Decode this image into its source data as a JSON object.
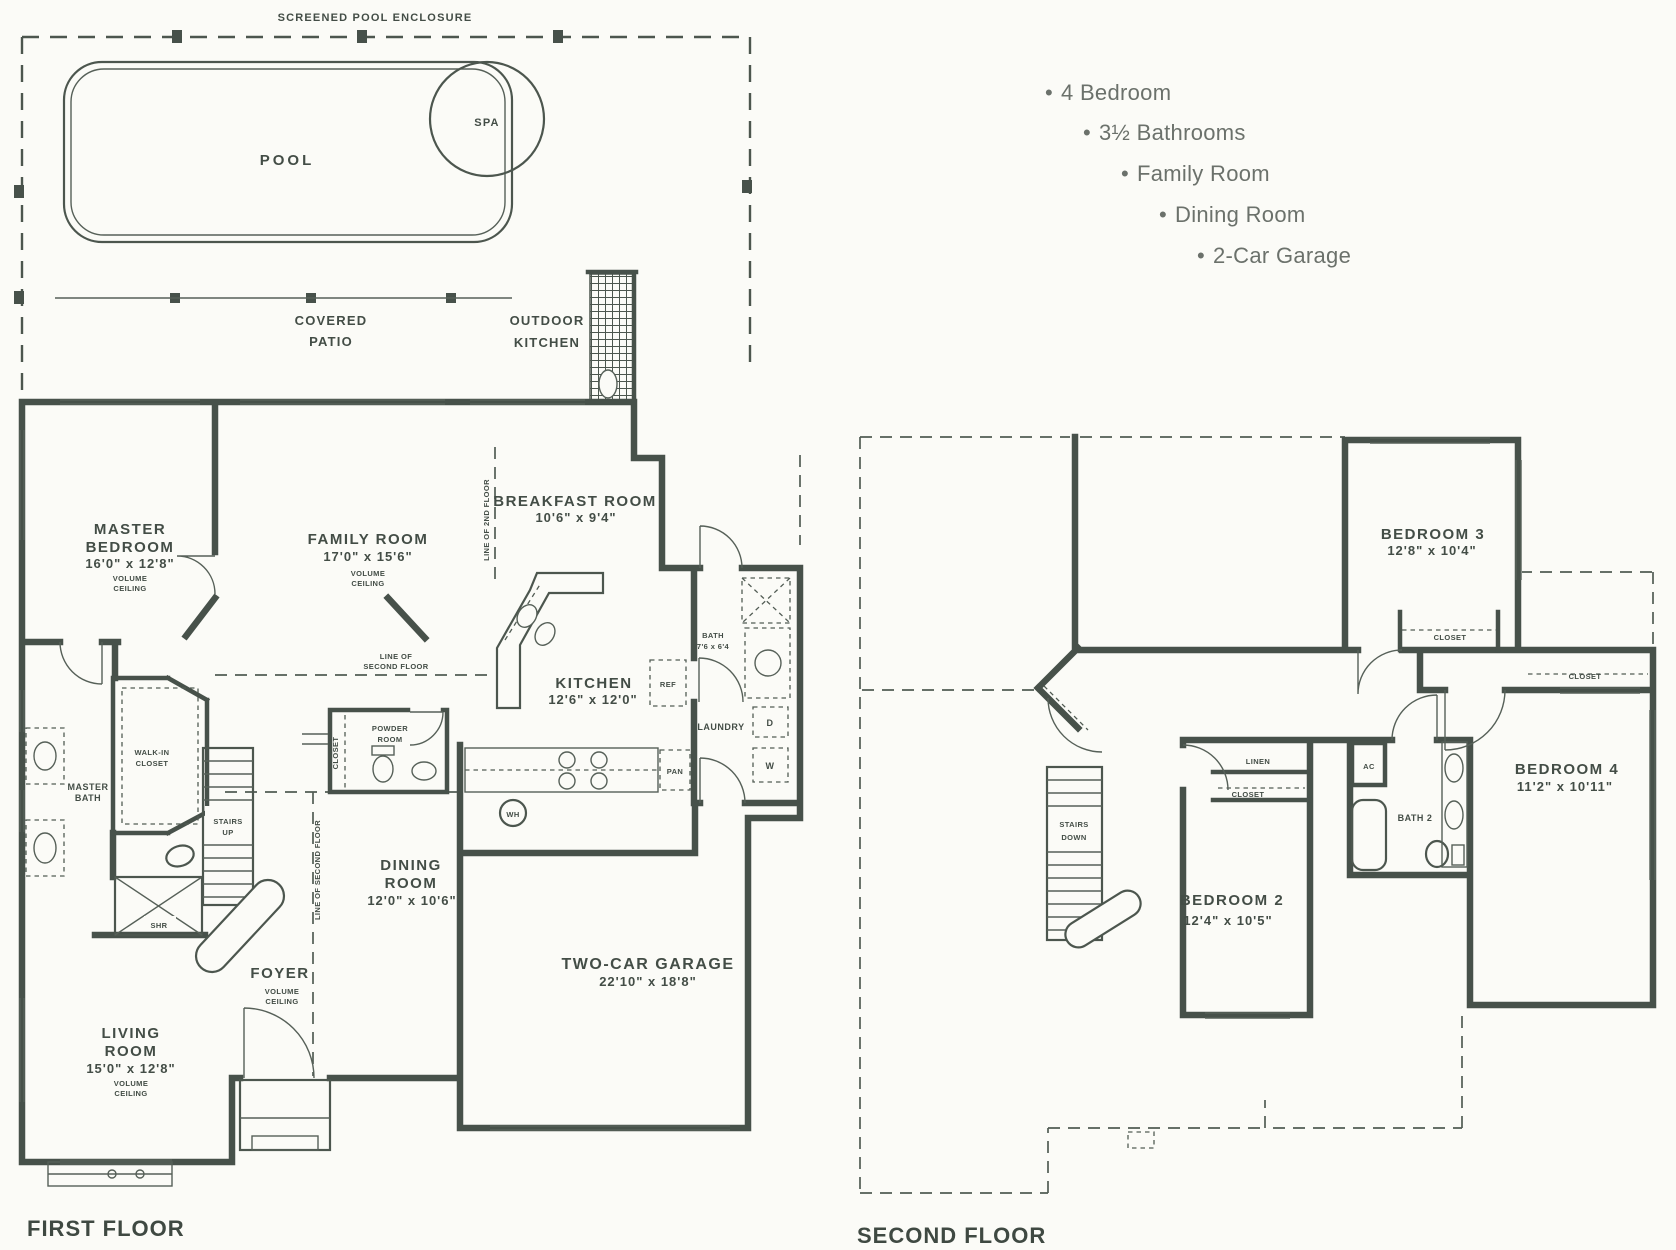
{
  "features": {
    "bullet": "•",
    "items": [
      "4 Bedroom",
      "3½ Bathrooms",
      "Family Room",
      "Dining Room",
      "2-Car Garage"
    ]
  },
  "outdoor": {
    "enclosure": "SCREENED POOL ENCLOSURE",
    "pool": "POOL",
    "spa": "SPA",
    "covered_patio": [
      "COVERED",
      "PATIO"
    ],
    "outdoor_kitchen": [
      "OUTDOOR",
      "KITCHEN"
    ]
  },
  "first_floor": {
    "title": "FIRST FLOOR",
    "rooms": {
      "master_bedroom": [
        "MASTER",
        "BEDROOM",
        "16'0\" x 12'8\"",
        "VOLUME",
        "CEILING"
      ],
      "family_room": [
        "FAMILY ROOM",
        "17'0\" x 15'6\"",
        "VOLUME",
        "CEILING"
      ],
      "breakfast_room": [
        "BREAKFAST ROOM",
        "10'6\" x 9'4\""
      ],
      "kitchen": [
        "KITCHEN",
        "12'6\" x 12'0\""
      ],
      "dining_room": [
        "DINING",
        "ROOM",
        "12'0\" x 10'6\""
      ],
      "living_room": [
        "LIVING",
        "ROOM",
        "15'0\" x 12'8\"",
        "VOLUME",
        "CEILING"
      ],
      "garage": [
        "TWO-CAR GARAGE",
        "22'10\" x 18'8\""
      ],
      "foyer": [
        "FOYER",
        "VOLUME",
        "CEILING"
      ],
      "master_bath": [
        "MASTER",
        "BATH"
      ],
      "walk_in_closet": [
        "WALK-IN",
        "CLOSET"
      ],
      "powder_room": [
        "POWDER",
        "ROOM"
      ],
      "bath": [
        "BATH",
        "7'6 x 6'4"
      ],
      "stairs": [
        "STAIRS",
        "UP"
      ]
    },
    "small_labels": {
      "shr": "SHR",
      "closet": "CLOSET",
      "ref": "REF",
      "pan": "PAN",
      "wh": "WH",
      "laundry": "LAUNDRY",
      "dryer": "D",
      "washer": "W",
      "line_of": "LINE OF",
      "second_floor": "SECOND FLOOR",
      "line_of_2nd_floor": "LINE OF 2ND FLOOR",
      "line_of_second_floor": "LINE OF SECOND FLOOR"
    }
  },
  "second_floor": {
    "title": "SECOND FLOOR",
    "rooms": {
      "bedroom_2": [
        "BEDROOM 2",
        "12'4\" x 10'5\""
      ],
      "bedroom_3": [
        "BEDROOM 3",
        "12'8\" x 10'4\""
      ],
      "bedroom_4": [
        "BEDROOM 4",
        "11'2\" x 10'11\""
      ],
      "bath_2": [
        "BATH 2"
      ],
      "stairs": [
        "STAIRS",
        "DOWN"
      ]
    },
    "small_labels": {
      "linen": "LINEN",
      "closet_bedroom3": "CLOSET",
      "closet_bedroom4": "CLOSET",
      "closet_bedroom2": "CLOSET",
      "ac": "AC"
    }
  }
}
